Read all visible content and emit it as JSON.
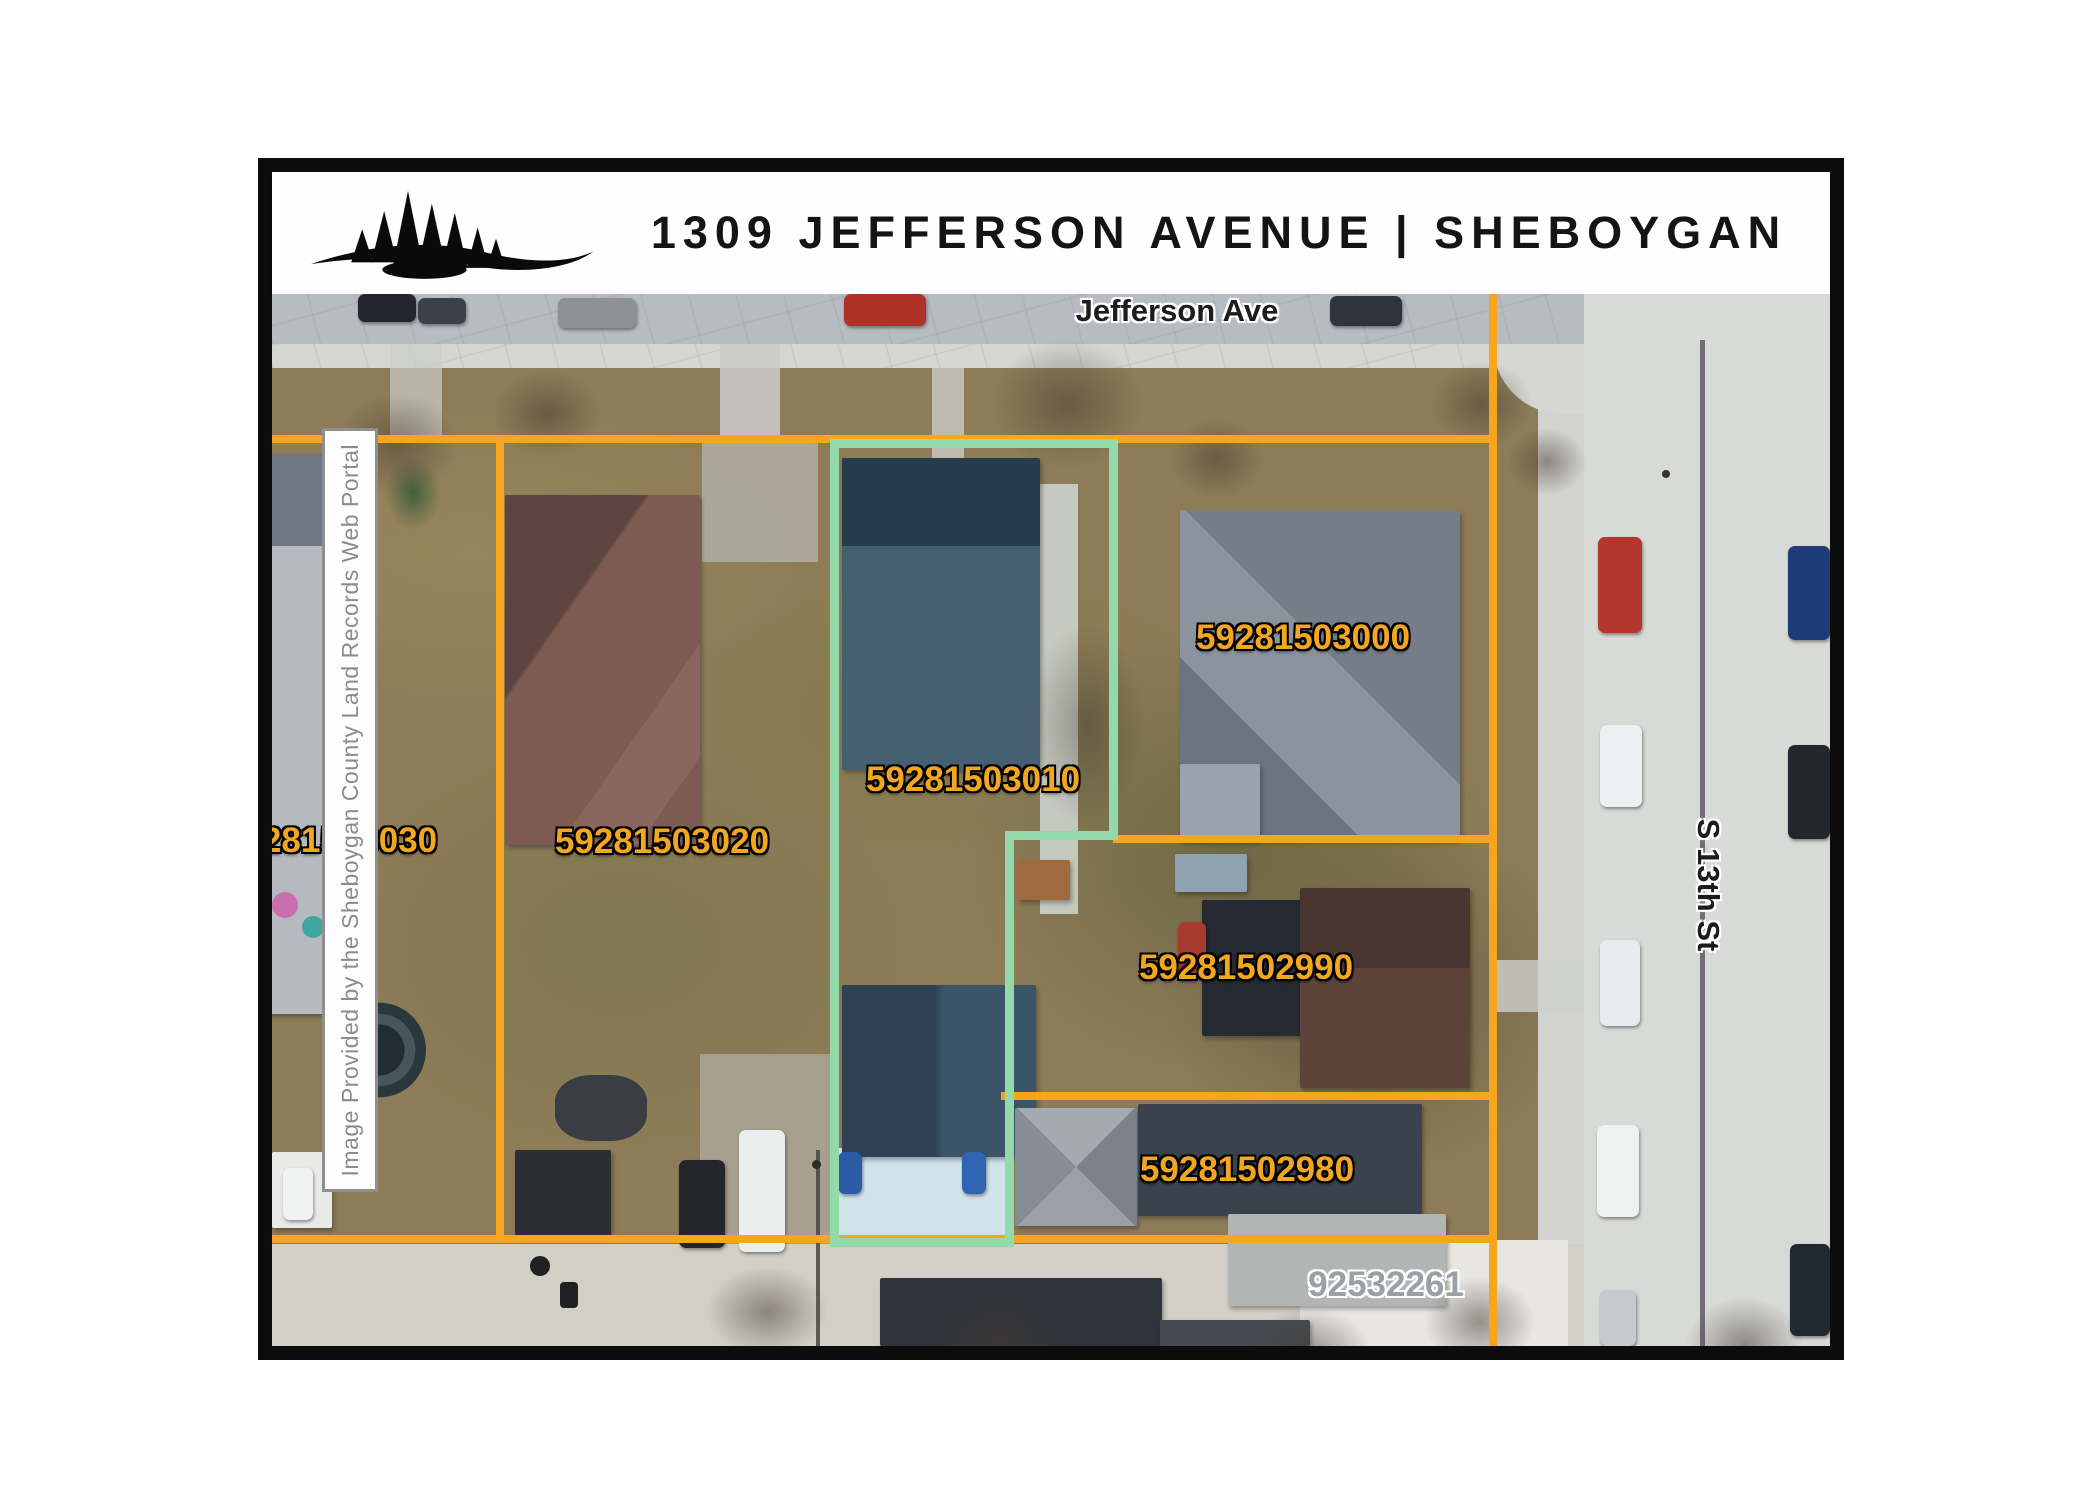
{
  "header": {
    "title": "1309 JEFFERSON AVENUE | SHEBOYGAN",
    "logo": "pine-trees-logo"
  },
  "map": {
    "street_labels": {
      "top": "Jefferson Ave",
      "right": "S 13th St"
    },
    "watermark": "Image Provided by the Sheboygan County Land Records Web Portal",
    "parcels": [
      {
        "id": "59281503000"
      },
      {
        "id": "59281503010",
        "subject": true
      },
      {
        "id": "59281503020"
      },
      {
        "id": "59281503030"
      },
      {
        "id": "59281502990"
      },
      {
        "id": "59281502980"
      },
      {
        "id": "92532261"
      }
    ],
    "colors": {
      "boundary_line": "#f6a51c",
      "subject_outline": "#93d9a9",
      "parcel_label": "#f2a71e",
      "alt_parcel_label": "#9aa0a6"
    }
  }
}
